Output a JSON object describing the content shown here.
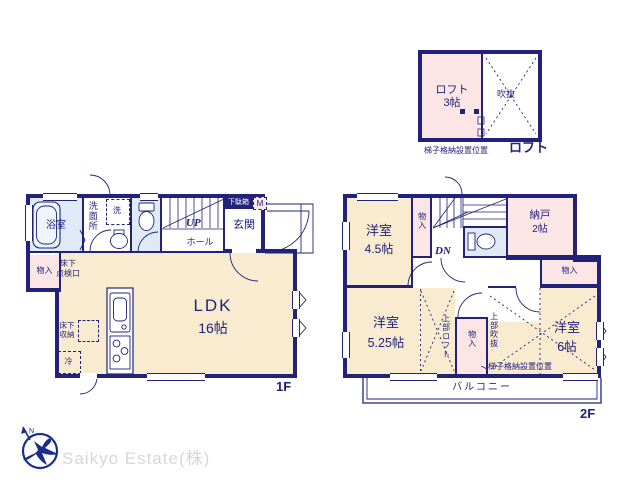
{
  "colors": {
    "wall_navy": "#22227b",
    "text_navy": "#1e1e78",
    "room_cream": "#f8ebcf",
    "room_pink": "#fbe5e5",
    "room_blue": "#dfeaf6",
    "logo_navy": "#1b2d8a",
    "logo_text_gray": "#d7d7d7"
  },
  "logo": {
    "company": "Saikyo Estate(株)",
    "north": "N"
  },
  "loft_plan": {
    "room_name": "ロフト",
    "room_size": "3帖",
    "void_label": "吹抜",
    "ladder_note": "梯子格納設置位置",
    "floor_caption": "ロフト"
  },
  "floor1": {
    "caption": "1F",
    "bath": "浴室",
    "washroom": "洗面所",
    "washer": "洗",
    "up": "UP",
    "hall": "ホール",
    "shoe_box": "下駄箱",
    "meter_box": "M",
    "entrance": "玄関",
    "closet": "物入",
    "underfloor_hatch": "床下\n点検口",
    "ldk_name": "LDK",
    "ldk_size": "16帖",
    "underfloor_storage": "床下\n収納",
    "fridge": "冷"
  },
  "floor2": {
    "caption": "2F",
    "room_w_name": "洋室",
    "room_w_size": "4.5帖",
    "closet_a": "物入",
    "dn": "DN",
    "storage_name": "納戸",
    "storage_size": "2帖",
    "closet_b": "物入",
    "room_sw_name": "洋室",
    "room_sw_size": "5.25帖",
    "loft_above": "上部ロフト",
    "closet_c": "物入",
    "void_above": "上部吹抜",
    "ladder_note": "梯子格納設置位置",
    "room_se_name": "洋室",
    "room_se_size": "6帖",
    "balcony": "バルコニー"
  }
}
